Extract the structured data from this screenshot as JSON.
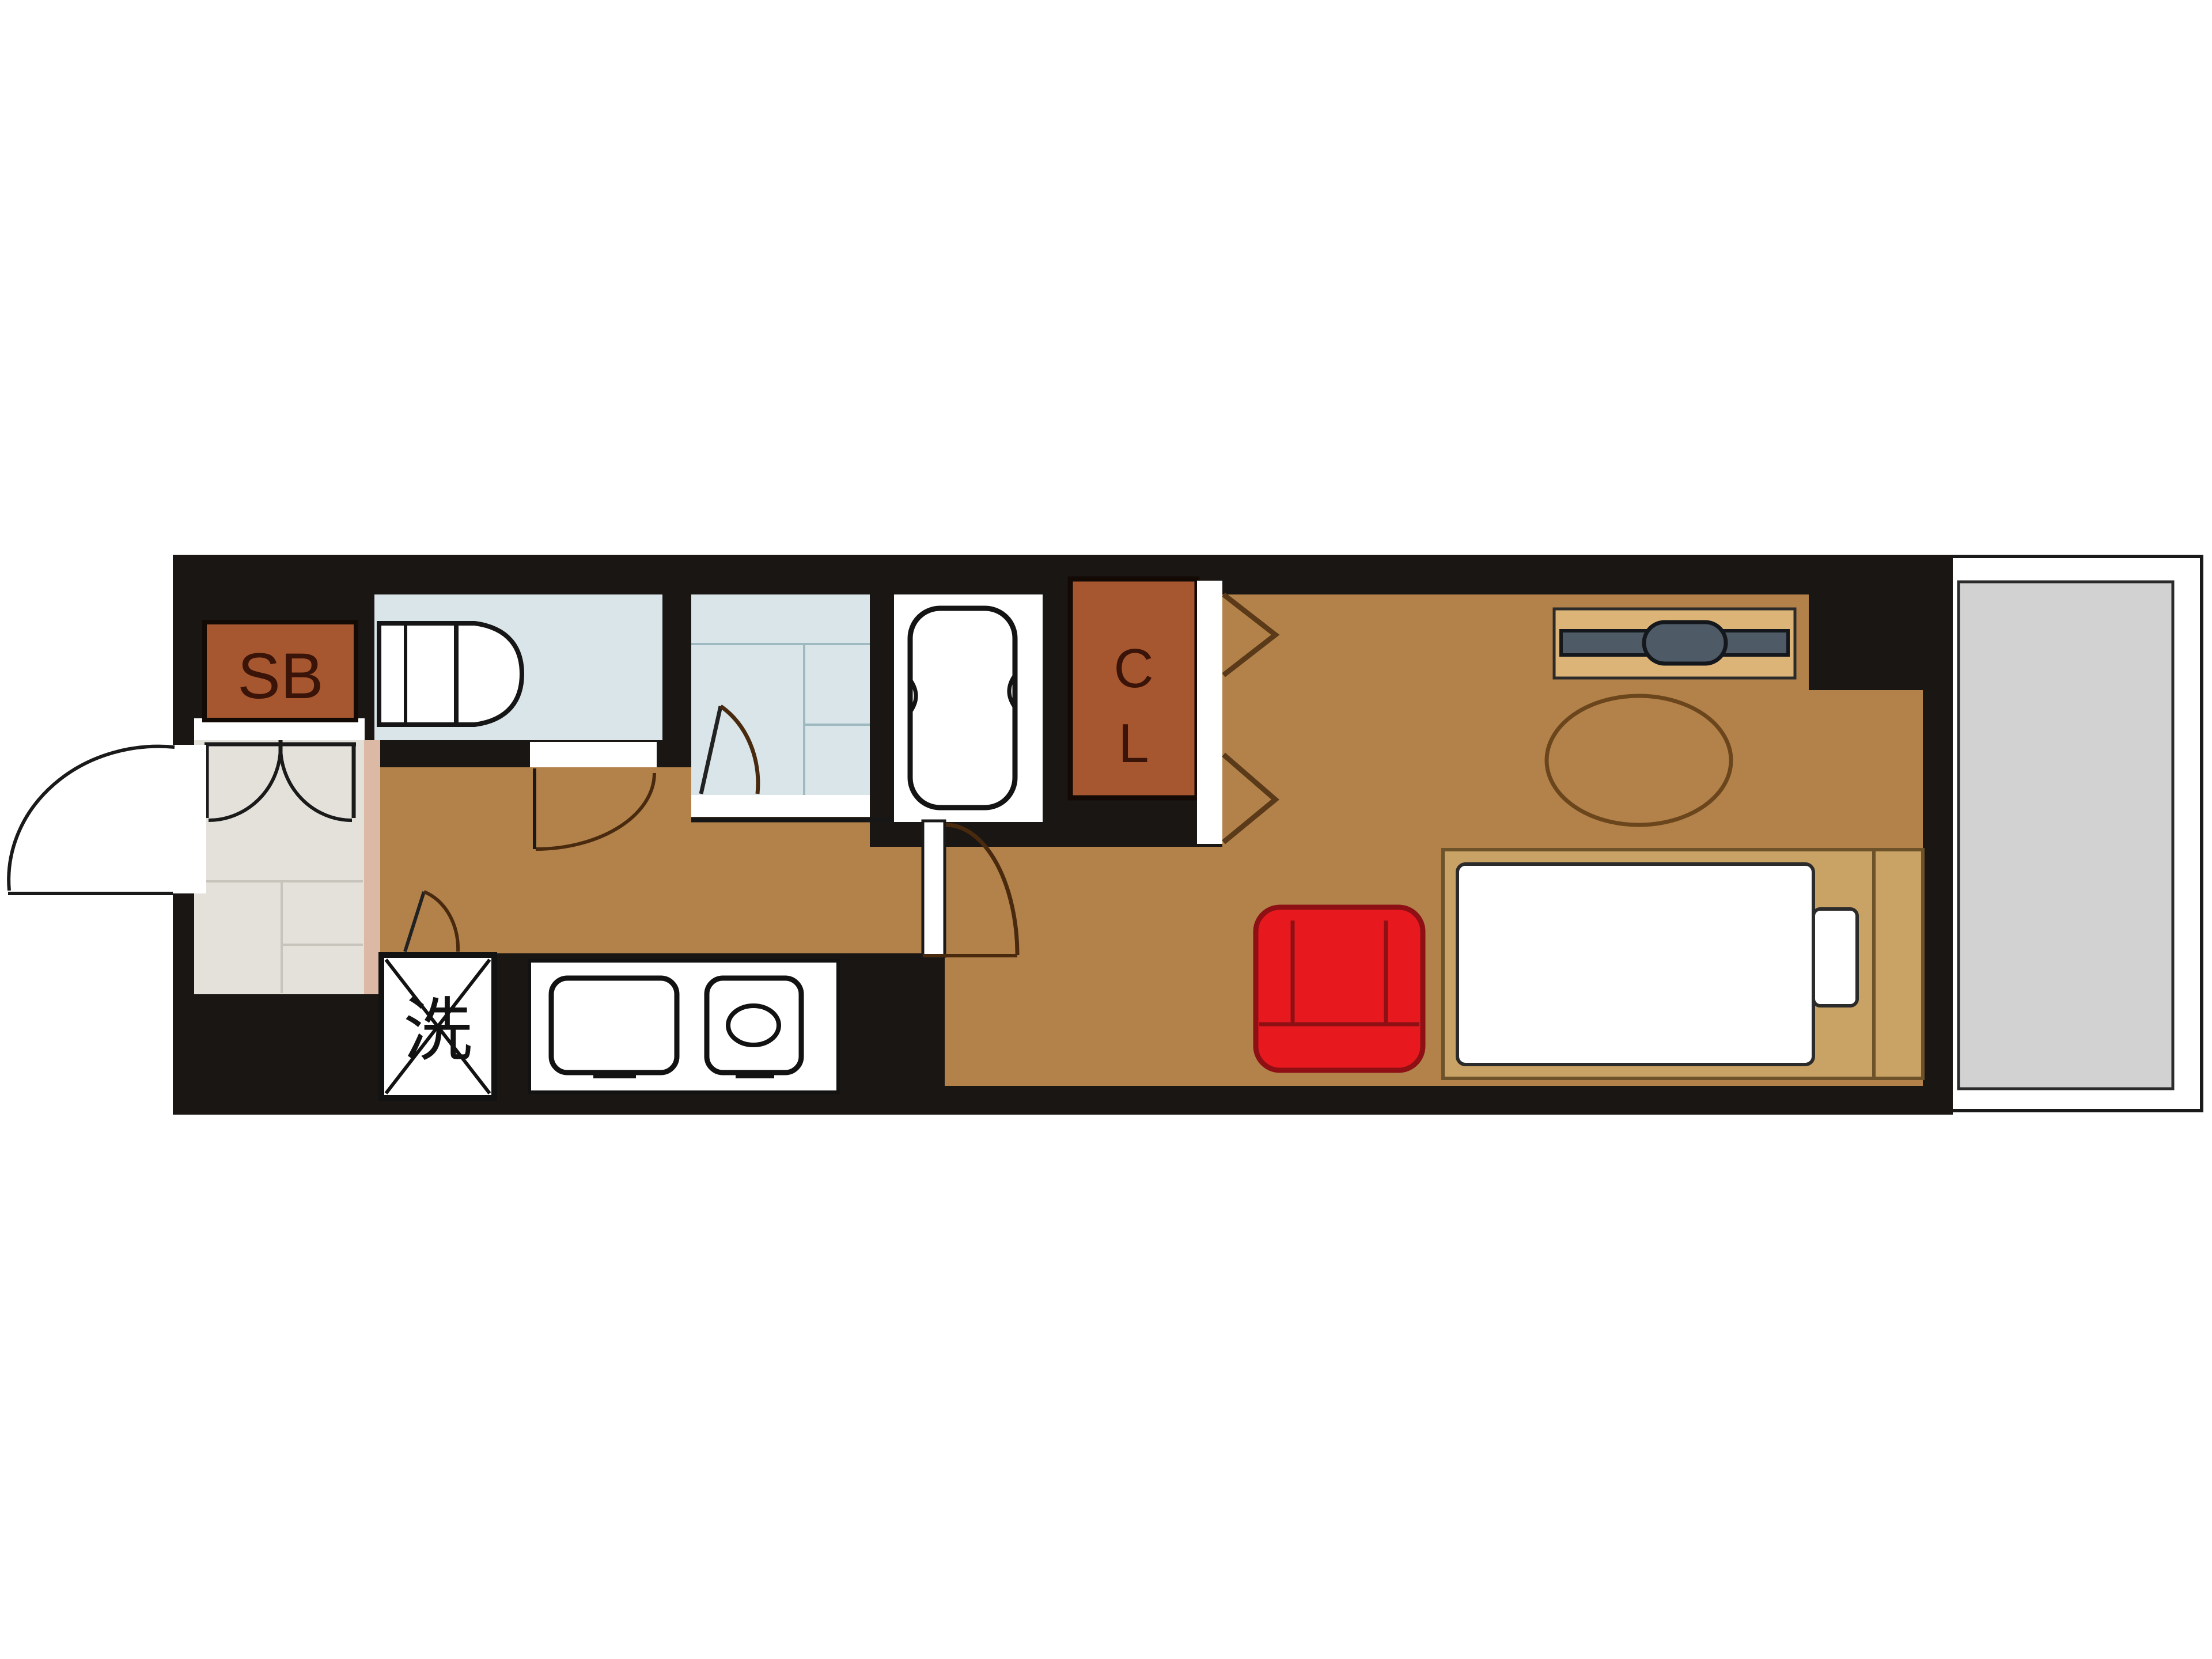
{
  "plan": {
    "labels": {
      "shoe_box": "SB",
      "closet_line1": "C",
      "closet_line2": "L",
      "washing_machine": "洗"
    },
    "palette": {
      "wall": "#1A1613",
      "floor": "#B2824A",
      "rust": "#A6572F",
      "wet_blue": "#D9E5E9",
      "entrance_gray": "#E4E1DB",
      "step_pink": "#DCB9A4",
      "balcony_gray": "#D2D2D2",
      "bed_frame": "#C9A266",
      "tv_board": "#DCB477",
      "tv_gray": "#4E5A66",
      "chair_red": "#E8191E",
      "chair_dark": "#8E1014",
      "door_line": "#4A2A0F",
      "label_dark": "#3A1408",
      "white": "#FFFFFF"
    }
  }
}
